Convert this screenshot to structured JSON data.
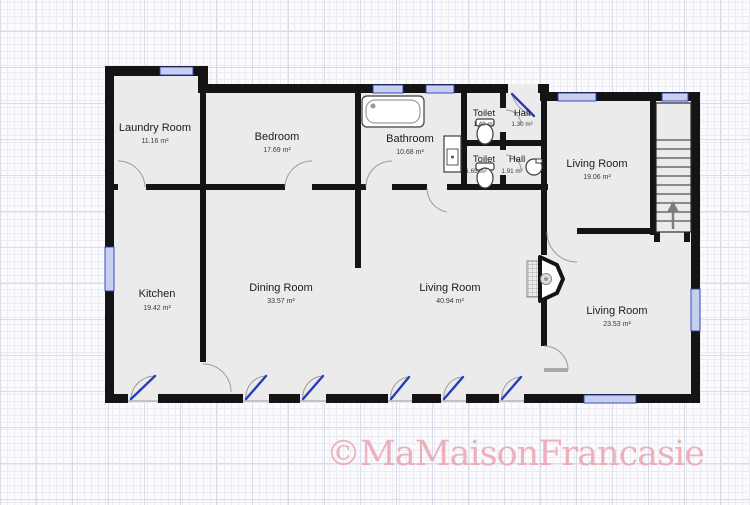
{
  "rooms": {
    "laundry": {
      "name": "Laundry Room",
      "area": "11.16 m²"
    },
    "bedroom": {
      "name": "Bedroom",
      "area": "17.69 m²"
    },
    "bathroom": {
      "name": "Bathroom",
      "area": "10.68 m²"
    },
    "toilet_top": {
      "name": "Toilet",
      "area": "1.40 m²"
    },
    "hall_top": {
      "name": "Hall",
      "area": "1.30 m²"
    },
    "toilet_bottom": {
      "name": "Toilet",
      "area": "1.65 m²"
    },
    "hall_bottom": {
      "name": "Hall",
      "area": "1.91 m²"
    },
    "living_top_right": {
      "name": "Living Room",
      "area": "19.06 m²"
    },
    "kitchen": {
      "name": "Kitchen",
      "area": "19.42 m²"
    },
    "dining": {
      "name": "Dining Room",
      "area": "33.57 m²"
    },
    "living_center": {
      "name": "Living Room",
      "area": "40.94 m²"
    },
    "living_bottom_right": {
      "name": "Living Room",
      "area": "23.53 m²"
    }
  },
  "watermark": {
    "text": "©MaMaisonFrancasie"
  },
  "colors": {
    "wall": "#141414",
    "room_fill": "#ebebeb",
    "window_line": "#2a3cb8",
    "window_fill": "#c7cfee",
    "door_arc": "#9a9a9a",
    "watermark": "#ea9fae",
    "grid_minor": "#ebecf3",
    "grid_major": "#dadde9"
  }
}
